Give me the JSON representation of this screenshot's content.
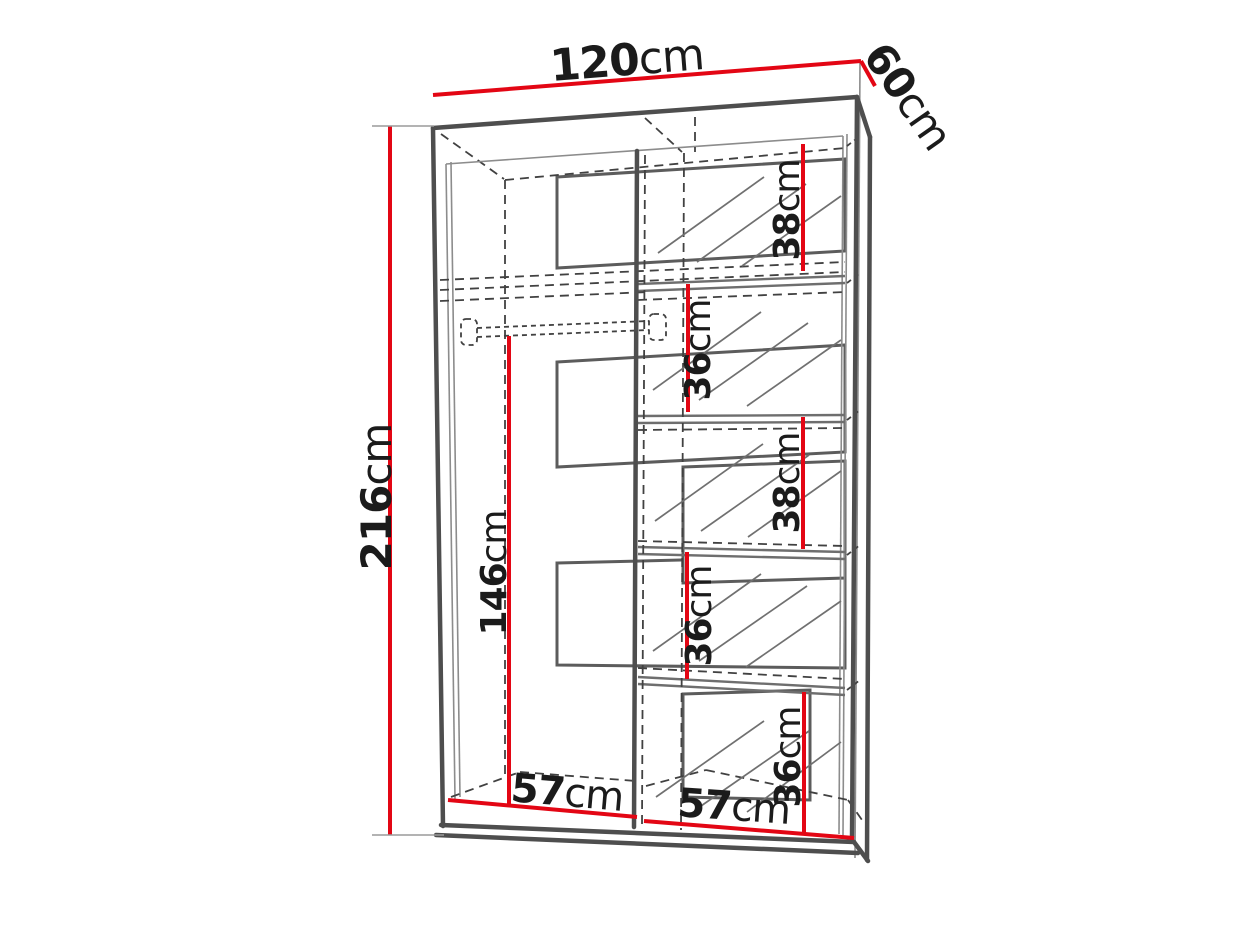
{
  "drawing": {
    "subject": "wardrobe interior dimension diagram",
    "accent_color": "#e30614",
    "outline_color": "#4e4e4e"
  },
  "dimensions": {
    "width": {
      "value": "120",
      "unit": "cm"
    },
    "depth": {
      "value": "60",
      "unit": "cm"
    },
    "height": {
      "value": "216",
      "unit": "cm"
    },
    "hanging_height": {
      "value": "146",
      "unit": "cm"
    },
    "left_section_width": {
      "value": "57",
      "unit": "cm"
    },
    "right_section_width": {
      "value": "57",
      "unit": "cm"
    },
    "shelf_gaps": [
      {
        "value": "38",
        "unit": "cm"
      },
      {
        "value": "36",
        "unit": "cm"
      },
      {
        "value": "38",
        "unit": "cm"
      },
      {
        "value": "36",
        "unit": "cm"
      },
      {
        "value": "36",
        "unit": "cm"
      }
    ]
  }
}
